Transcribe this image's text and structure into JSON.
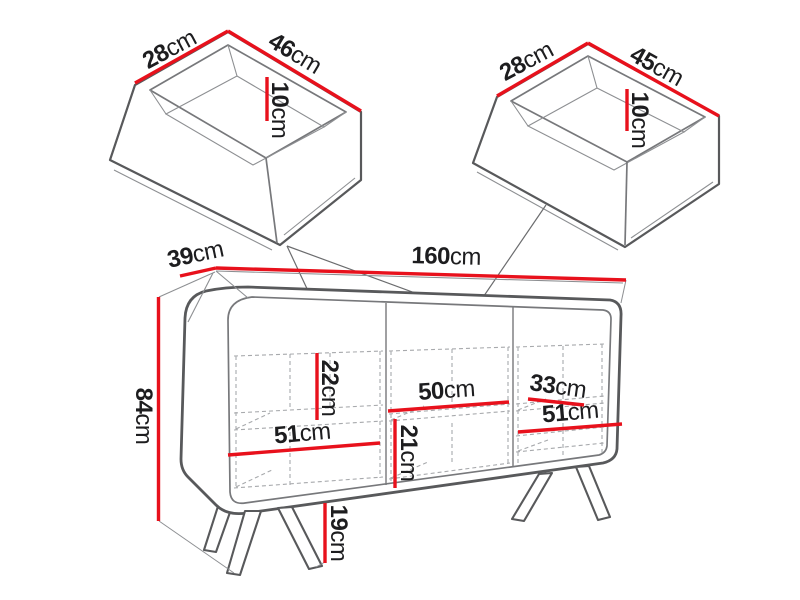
{
  "colors": {
    "dimension_line": "#e8111c",
    "outline": "#58595b",
    "dashed_line": "#a7a9ac"
  },
  "cabinet": {
    "width": {
      "num": "160",
      "unit": "cm"
    },
    "depth": {
      "num": "39",
      "unit": "cm"
    },
    "height": {
      "num": "84",
      "unit": "cm"
    },
    "leg_height": {
      "num": "19",
      "unit": "cm"
    },
    "left_compartment": {
      "inner_height": {
        "num": "22",
        "unit": "cm"
      },
      "inner_width": {
        "num": "51",
        "unit": "cm"
      }
    },
    "middle_compartment": {
      "inner_width": {
        "num": "50",
        "unit": "cm"
      },
      "inner_height": {
        "num": "21",
        "unit": "cm"
      }
    },
    "right_compartment": {
      "inner_width_upper": {
        "num": "33",
        "unit": "cm"
      },
      "inner_width": {
        "num": "51",
        "unit": "cm"
      }
    }
  },
  "drawer_left": {
    "depth": {
      "num": "28",
      "unit": "cm"
    },
    "width": {
      "num": "46",
      "unit": "cm"
    },
    "height": {
      "num": "10",
      "unit": "cm"
    }
  },
  "drawer_right": {
    "depth": {
      "num": "28",
      "unit": "cm"
    },
    "width": {
      "num": "45",
      "unit": "cm"
    },
    "height": {
      "num": "10",
      "unit": "cm"
    }
  }
}
